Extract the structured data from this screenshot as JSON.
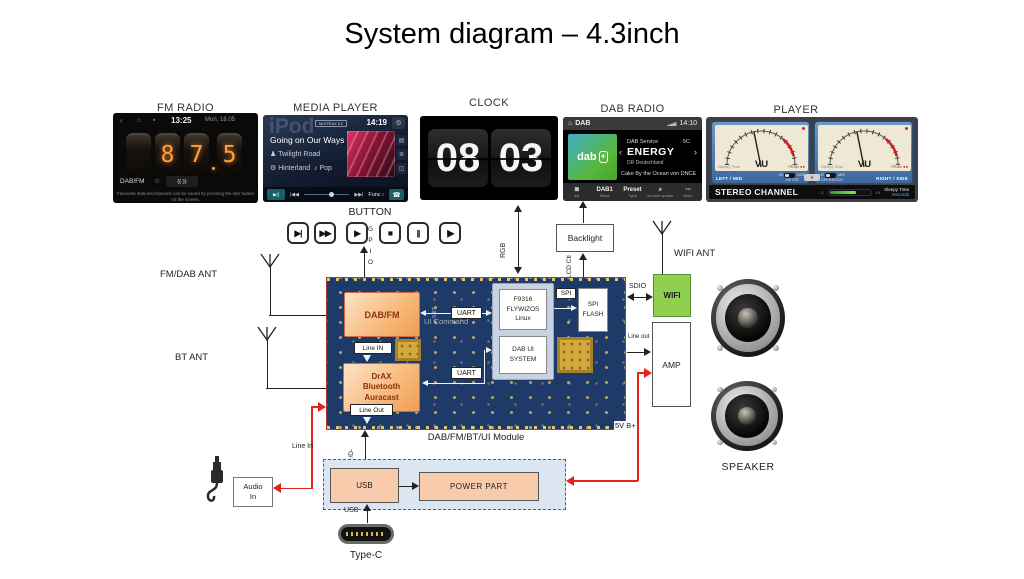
{
  "colors": {
    "pcb_navy": "#1d3a68",
    "chip_orange": "#f09d52",
    "wifi_green": "#8fd14f",
    "line_red": "#e8211d",
    "power_peach": "#f8cbad",
    "dab_green": "#58b63a"
  },
  "title": "System diagram – 4.3inch",
  "screens": {
    "fm": {
      "label": "FM RADIO",
      "nav_icons": [
        "‹",
        "⌂",
        "▪"
      ],
      "time": "13:25",
      "date": "Mon, 18.05",
      "digit1": "8",
      "digit2": "7",
      "digit3": "5",
      "band": "DAB/FM",
      "fav_icon": "☆",
      "signal_icon": "((·))",
      "caption1": "Favourite stations/channels can be saved by pressing the star button",
      "caption2": "on the screen."
    },
    "mp": {
      "label": "MEDIA PLAYER",
      "watermark": "iPod",
      "badge": "MIXTRAX EZ",
      "time": "14:19",
      "gear_icon": "⚙",
      "track": "Going on Our Ways",
      "artist_icon": "♟",
      "artist": "Twilight Road",
      "album_icon": "⚙",
      "album": "Hinterland",
      "genre_icon": "♪",
      "genre": "Pop",
      "side_icons": [
        "▤",
        "≣",
        "◫"
      ],
      "play": "▶||",
      "prev": "|◀◀",
      "next": "▶▶|",
      "func": "Func ›",
      "phone": "☎"
    },
    "clock": {
      "label": "CLOCK",
      "hours": "08",
      "minutes": "03"
    },
    "dab": {
      "label": "DAB RADIO",
      "home": "⌂",
      "band": "DAB",
      "signal": "▂▄▆",
      "time": "14:10",
      "logo": "dab",
      "logo_plus": "+",
      "service": "DAB Service",
      "channel": "5C",
      "station": "ENERGY",
      "ensemble": "DR Deutschland",
      "now_playing": "Cake By the Ocean von DNCE",
      "prev": "‹",
      "next": "›",
      "menu": [
        {
          "icon": "≣",
          "label": "list"
        },
        {
          "icon": "DAB1",
          "label": "Band"
        },
        {
          "icon": "Preset",
          "label": "Type"
        },
        {
          "icon": "⌕",
          "label": "service update"
        },
        {
          "icon": "⋯",
          "label": "More"
        }
      ]
    },
    "player": {
      "label": "PLAYER",
      "vu": "VU",
      "brand": "Sleepy Time",
      "brand2": "Records",
      "peak": "PEAK",
      "peak_dots": "●●",
      "left": "LEFT / MID",
      "right": "RIGHT / SIDE",
      "sw_in": "IN",
      "sw_out": "OUT",
      "sw_meter": "METER",
      "sw_lr": "LR",
      "sw_ms": "M/S",
      "sw_op": "OPERATION",
      "drop": "▾",
      "channel": "STEREO CHANNEL",
      "min": "-1",
      "max": "+1"
    }
  },
  "buttons": {
    "label": "BUTTON",
    "items": [
      "▶|",
      "▶▶",
      "▶",
      "■",
      "||",
      "|▶"
    ]
  },
  "conn": {
    "gpio": "GPIO",
    "rgb": "RGB",
    "lcd": "LCD Ctl",
    "sdio": "SDIO",
    "lineout": "Line out",
    "linein": "Line In",
    "dpdm": "D+/D-",
    "usb": "USB",
    "v5": "5V B+"
  },
  "ant": {
    "fmdab": "FM/DAB ANT",
    "bt": "BT ANT",
    "wifi": "WIFI ANT"
  },
  "module": {
    "caption": "DAB/FM/BT/UI Module",
    "dabfm": "DAB/FM",
    "bt1": "DrAX",
    "bt2": "Bluetooth",
    "bt3": "Auracast",
    "linein": "Line IN",
    "lineout": "Line Out",
    "uart": "UART",
    "uicmd": "UI Command",
    "silk": "0.6T",
    "soc1": "F9316",
    "soc2": "FLYWIZOS",
    "soc3": "Linux",
    "ui1": "DAB UI",
    "ui2": "SYSTEM",
    "spi": "SPI",
    "flash1": "SPI",
    "flash2": "FLASH"
  },
  "blocks": {
    "backlight": "Backlight",
    "wifi": "WIFI",
    "amp": "AMP",
    "audio1": "Audio",
    "audio2": "In",
    "usb": "USB",
    "power": "POWER PART",
    "typec": "Type-C",
    "speaker": "SPEAKER"
  }
}
